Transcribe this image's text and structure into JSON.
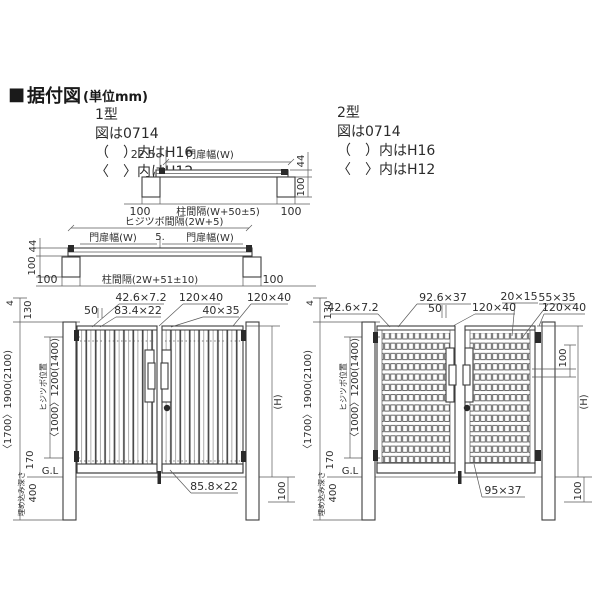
{
  "header": {
    "marker": "■",
    "title": "据付図",
    "unit": "(単位mm)"
  },
  "type1": {
    "notes": [
      "1型",
      "図は0714",
      "（　）内はH16",
      "〈　〉内はH12"
    ]
  },
  "type2": {
    "notes": [
      "2型",
      "図は0714",
      "（　）内はH16",
      "〈　〉内はH12"
    ]
  },
  "plan_single": {
    "dim_hinge_offset": "22.5",
    "leaf_width": "門扉幅(W)",
    "dim_depth": "44",
    "dim_post_depth": "100",
    "dim_post_left": "100",
    "post_spacing": "柱間隔(W+50±5)",
    "dim_post_right": "100"
  },
  "plan_double": {
    "hinge_spacing": "ヒジツボ間隔(2W+5)",
    "leaf_width_left": "門扉幅(W)",
    "dim_center_gap": "5.",
    "leaf_width_right": "門扉幅(W)",
    "dim_depth": "44",
    "dim_post_depth": "100",
    "dim_post_left": "100",
    "post_spacing": "柱間隔(2W+51±10)",
    "dim_post_right": "100"
  },
  "elev1": {
    "pitch": "50",
    "slat_section": "42.6×7.2",
    "wide_slat_section": "83.4×22",
    "top_rail_section": "120×40",
    "stile_section": "40×35",
    "top_rail_right_section": "120×40",
    "bottom_rail_section": "85.8×22",
    "left": {
      "d4": "4",
      "d130": "130",
      "total_height": "〈1700〉1900(2100)",
      "hinge_pos_label": "ヒジツボ位置",
      "hinge_pos": "〈1000〉1200(1400)",
      "d170": "170",
      "embed_label": "埋め込み深さ",
      "embed": "400",
      "gl": "G.L"
    },
    "right": {
      "height": "(H)",
      "d100": "100"
    }
  },
  "elev2": {
    "frame_section": "42.6×7.2",
    "rail_section": "92.6×37",
    "pitch": "50",
    "top_rail_section": "120×40",
    "hole_section": "20×15",
    "slat_section": "55×35",
    "top_rail_right_section": "120×40",
    "bottom_rail_section": "95×37",
    "rail_pitch": "100",
    "left": {
      "d4": "4",
      "d130": "130",
      "total_height": "〈1700〉1900(2100)",
      "hinge_pos_label": "ヒジツボ位置",
      "hinge_pos": "〈1000〉1200(1400)",
      "d170": "170",
      "embed_label": "埋め込み深さ",
      "embed": "400",
      "gl": "G.L"
    },
    "right": {
      "height": "(H)",
      "d100": "100"
    }
  }
}
